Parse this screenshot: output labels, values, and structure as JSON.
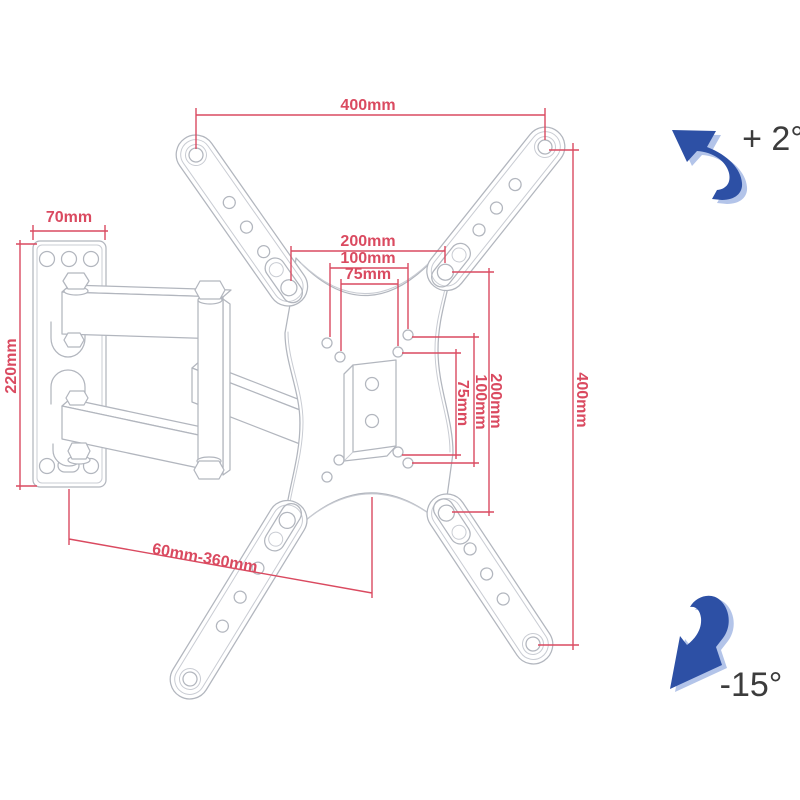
{
  "diagram": {
    "colors": {
      "dimension_red": "#da4a60",
      "outline_gray": "#b2b6be",
      "arrow_blue": "#2d50a5",
      "arrow_blue_light": "#b3c4e9",
      "angle_text_gray": "#3c3c3c",
      "background": "#ffffff"
    },
    "labels": {
      "vesa_width_top": "400mm",
      "vesa_height_right": "400mm",
      "wall_plate_width": "70mm",
      "wall_plate_height": "220mm",
      "hole_pattern_horizontal": {
        "outer": "200mm",
        "middle": "100mm",
        "inner": "75mm"
      },
      "hole_pattern_vertical": {
        "inner": "75mm",
        "middle": "100mm",
        "outer": "200mm"
      },
      "extension_range": "60mm-360mm",
      "tilt_up": "+ 2°",
      "tilt_down": "-15°"
    },
    "icons": {
      "tilt_up_arrow": "curved-rotation-arrow-up-left",
      "tilt_down_arrow": "curved-rotation-arrow-down-left"
    }
  }
}
